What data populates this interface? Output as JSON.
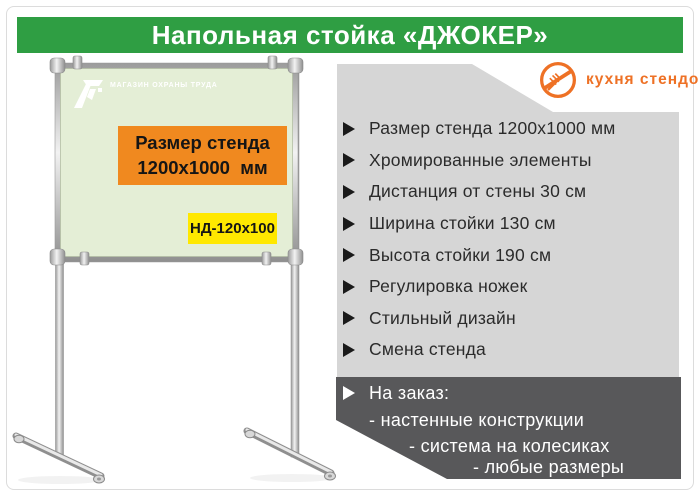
{
  "header": {
    "title": "Напольная стойка «ДЖОКЕР»"
  },
  "brand": {
    "label": "кухня стендов",
    "icon": "no-kitchen-fork-icon",
    "color": "#ee7125"
  },
  "board": {
    "logo_text": "МАГАЗИН ОХРАНЫ ТРУДА",
    "size_badge_line1": "Размер стенда",
    "size_badge_line2": "1200х1000  мм",
    "model_code": "НД-120х100",
    "face_color": "#e4eed6",
    "size_badge_color": "#f0891f",
    "model_badge_color": "#ffe800"
  },
  "specs": {
    "items": [
      "Размер стенда 1200х1000 мм",
      "Хромированные элементы",
      "Дистанция от стены 30 см",
      "Ширина стойки 130 см",
      "Высота стойки 190 см",
      "Регулировка ножек",
      "Стильный дизайн",
      "Смена стенда"
    ],
    "panel_color": "#d6d6d6"
  },
  "order": {
    "title": "На заказ:",
    "lines": [
      "- настенные конструкции",
      "- система на колесиках",
      "- любые размеры"
    ],
    "panel_color": "#58585a"
  },
  "colors": {
    "header_green": "#2f9e43",
    "text_dark": "#2b2b2b"
  }
}
